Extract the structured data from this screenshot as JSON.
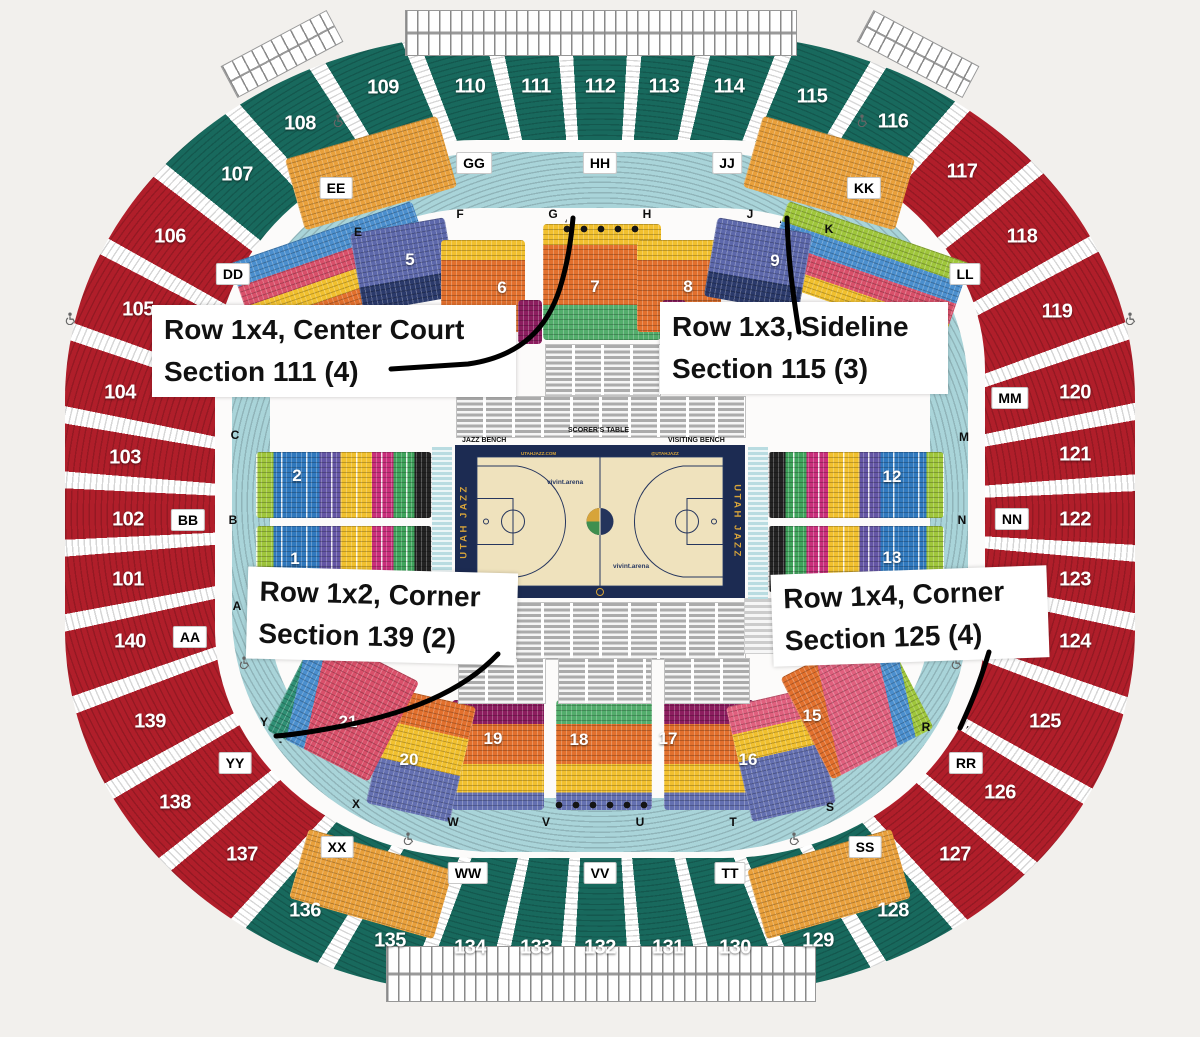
{
  "annotations": [
    {
      "line1": "Row 1x4, Center Court",
      "line2": "Section 111 (4)"
    },
    {
      "line1": "Row 1x3, Sideline",
      "line2": "Section 115 (3)"
    },
    {
      "line1": "Row 1x2, Corner",
      "line2": "Section 139 (2)"
    },
    {
      "line1": "Row 1x4, Corner",
      "line2": "Section 125 (4)"
    }
  ],
  "outer_sections": [
    {
      "label": "101",
      "color": "red"
    },
    {
      "label": "102",
      "color": "red"
    },
    {
      "label": "103",
      "color": "red"
    },
    {
      "label": "104",
      "color": "red"
    },
    {
      "label": "105",
      "color": "red"
    },
    {
      "label": "106",
      "color": "red"
    },
    {
      "label": "107",
      "color": "green"
    },
    {
      "label": "108",
      "color": "green"
    },
    {
      "label": "109",
      "color": "green"
    },
    {
      "label": "110",
      "color": "green"
    },
    {
      "label": "111",
      "color": "green"
    },
    {
      "label": "112",
      "color": "green"
    },
    {
      "label": "113",
      "color": "green"
    },
    {
      "label": "114",
      "color": "green"
    },
    {
      "label": "115",
      "color": "green"
    },
    {
      "label": "116",
      "color": "green"
    },
    {
      "label": "117",
      "color": "red"
    },
    {
      "label": "118",
      "color": "red"
    },
    {
      "label": "119",
      "color": "red"
    },
    {
      "label": "120",
      "color": "red"
    },
    {
      "label": "121",
      "color": "red"
    },
    {
      "label": "122",
      "color": "red"
    },
    {
      "label": "123",
      "color": "red"
    },
    {
      "label": "124",
      "color": "red"
    },
    {
      "label": "125",
      "color": "red"
    },
    {
      "label": "126",
      "color": "red"
    },
    {
      "label": "127",
      "color": "red"
    },
    {
      "label": "128",
      "color": "green"
    },
    {
      "label": "129",
      "color": "green"
    },
    {
      "label": "130",
      "color": "green"
    },
    {
      "label": "131",
      "color": "green"
    },
    {
      "label": "132",
      "color": "green"
    },
    {
      "label": "133",
      "color": "green"
    },
    {
      "label": "134",
      "color": "green"
    },
    {
      "label": "135",
      "color": "green"
    },
    {
      "label": "136",
      "color": "green"
    },
    {
      "label": "137",
      "color": "red"
    },
    {
      "label": "138",
      "color": "red"
    },
    {
      "label": "139",
      "color": "red"
    },
    {
      "label": "140",
      "color": "red"
    }
  ],
  "terrace_boxes": [
    "AA",
    "BB",
    "DD",
    "EE",
    "GG",
    "HH",
    "JJ",
    "KK",
    "LL",
    "MM",
    "NN",
    "RR",
    "SS",
    "TT",
    "VV",
    "WW",
    "XX",
    "YY"
  ],
  "row_letters": [
    "A",
    "B",
    "C",
    "E",
    "F",
    "G",
    "H",
    "J",
    "K",
    "L",
    "M",
    "N",
    "R",
    "S",
    "T",
    "U",
    "V",
    "W",
    "X",
    "Y"
  ],
  "inner_sections": [
    "1",
    "2",
    "5",
    "6",
    "7",
    "8",
    "9",
    "12",
    "13",
    "15",
    "16",
    "17",
    "18",
    "19",
    "20",
    "21"
  ],
  "court": {
    "team_left": "UTAH JAZZ",
    "team_right": "UTAH JAZZ",
    "url": "UTAHJAZZ.COM",
    "handle": "@UTAHJAZZ",
    "arena_logo_top": "vivint.arena",
    "arena_logo_bottom": "vivint.arena",
    "bench_home": "JAZZ BENCH",
    "scorers_table": "SCORER'S TABLE",
    "bench_visitor": "VISITING BENCH"
  },
  "price_stripes_left": [
    "#9fc63b",
    "#3079be",
    "#6456a5",
    "#f1c02e",
    "#c92f7b",
    "#3fa45c",
    "#222222"
  ],
  "price_stripes_right": [
    "#222222",
    "#3fa45c",
    "#c92f7b",
    "#f1c02e",
    "#6456a5",
    "#3079be",
    "#9fc63b"
  ],
  "colors": {
    "background": "#f2f0ed",
    "section_green": "#18695d",
    "section_red": "#b01e2a",
    "club_orange": "#e9a03b",
    "terrace_teal": "#a9d4d9",
    "bowl_orange": "#e2702d",
    "bowl_yellow": "#f1c02e",
    "bowl_plum": "#8c1d5f",
    "bowl_green": "#53ad6c",
    "bowl_slate": "#5d68ab",
    "bowl_navy": "#2b3a6b",
    "bowl_periwinkle": "#6470b1",
    "bowl_pink": "#e0607e",
    "bowl_red": "#d9506a",
    "bowl_skyblue": "#4b8fce",
    "bowl_teal": "#2f8f74",
    "bowl_lime": "#9fc63b",
    "court_navy": "#1c2b52",
    "court_floor": "#efe2bd",
    "court_gold": "#d7a43a",
    "annotation_text": "#111111",
    "arrow": "#000000"
  }
}
